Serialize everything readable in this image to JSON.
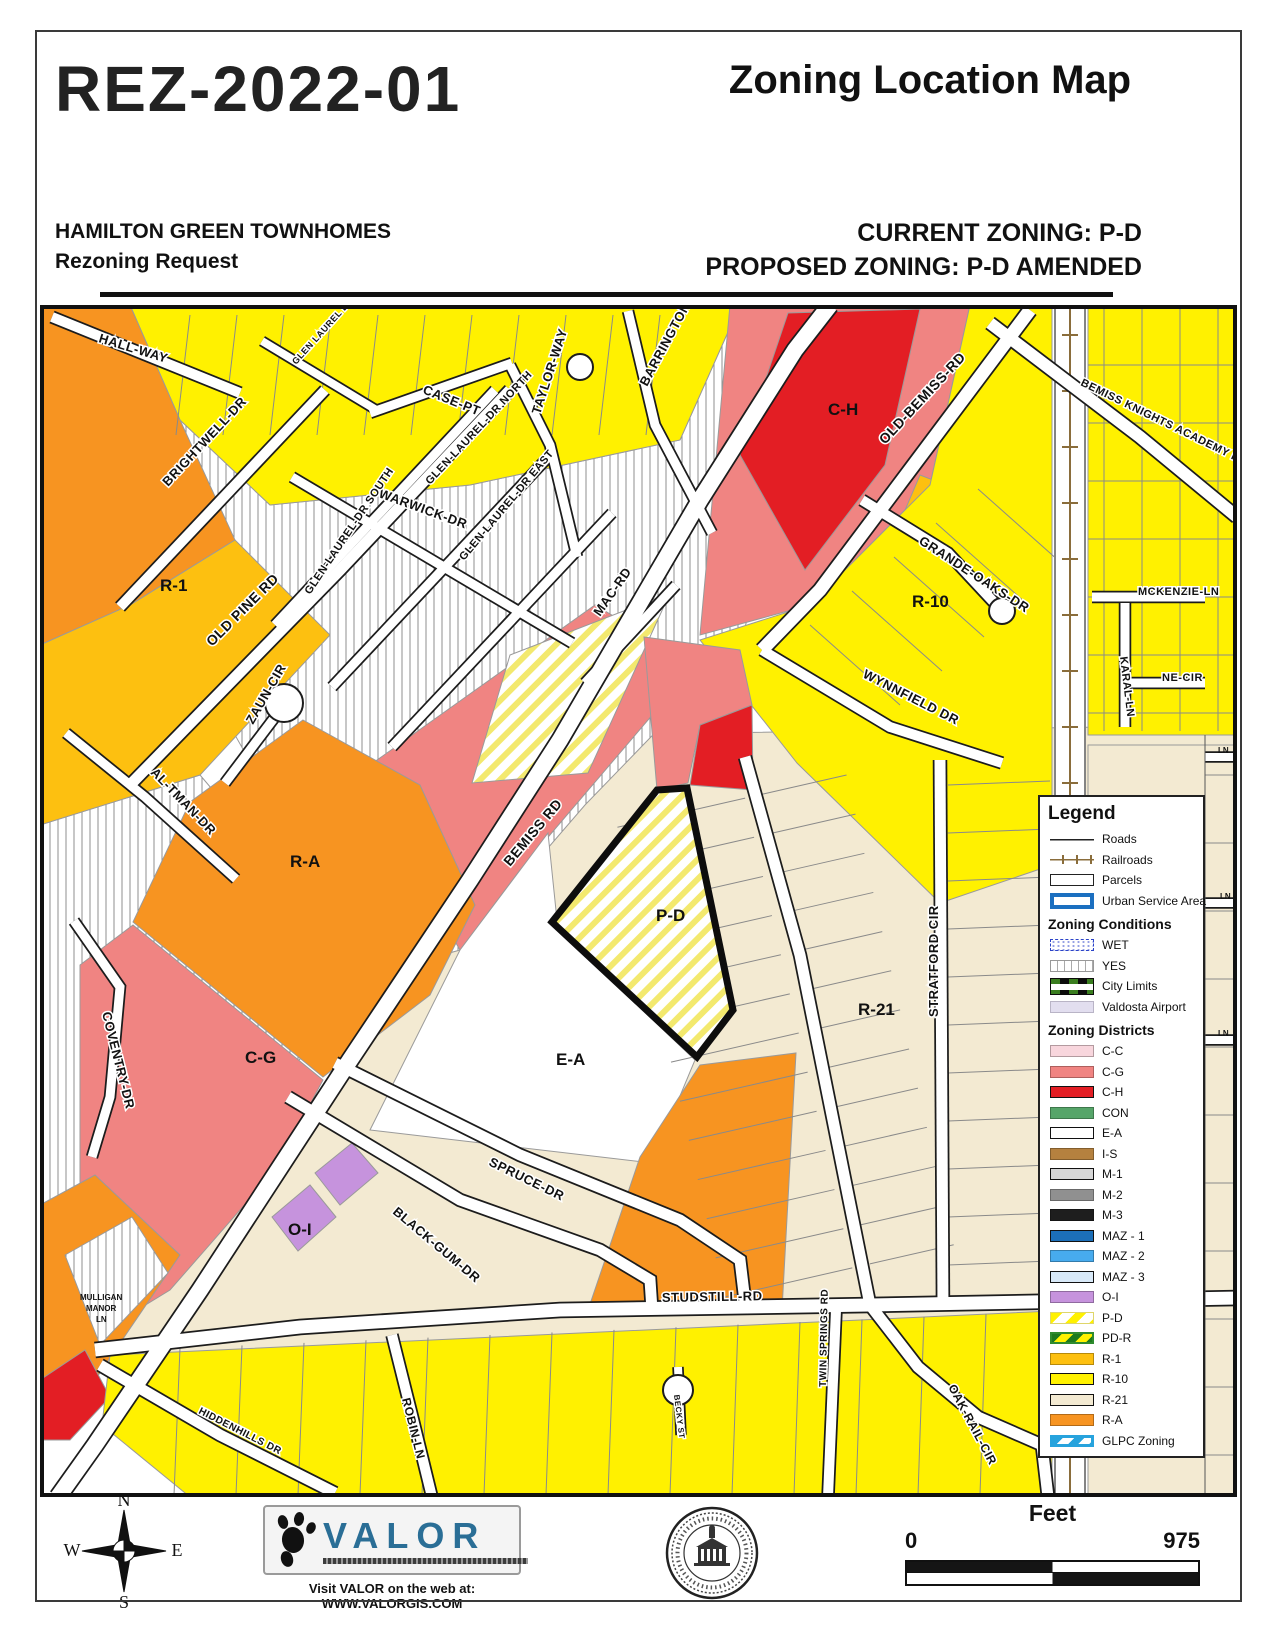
{
  "header": {
    "case_id": "REZ-2022-01",
    "map_title": "Zoning Location Map",
    "project_name": "HAMILTON GREEN TOWNHOMES",
    "request_type": "Rezoning Request",
    "current_zoning": "CURRENT ZONING: P-D",
    "proposed_zoning": "PROPOSED ZONING: P-D AMENDED"
  },
  "map": {
    "road_labels": [
      {
        "t": "HALL-WAY",
        "x": 58,
        "y": 37,
        "r": 17,
        "s": 13
      },
      {
        "t": "BRIGHTWELL-DR",
        "x": 128,
        "y": 182,
        "r": -47,
        "s": 13
      },
      {
        "t": "OLD PINE RD",
        "x": 172,
        "y": 342,
        "r": -45,
        "s": 14
      },
      {
        "t": "GLEN LAUREL DR",
        "x": 256,
        "y": 60,
        "r": -48,
        "s": 9
      },
      {
        "t": "CASE-PT",
        "x": 382,
        "y": 88,
        "r": 22,
        "s": 13
      },
      {
        "t": "TAYLOR-WAY",
        "x": 500,
        "y": 110,
        "r": -72,
        "s": 13
      },
      {
        "t": "BARRINGTON-DR",
        "x": 607,
        "y": 82,
        "r": -62,
        "s": 13
      },
      {
        "t": "GLEN-LAUREL-DR NORTH",
        "x": 390,
        "y": 180,
        "r": -47,
        "s": 11
      },
      {
        "t": "WARWICK-DR",
        "x": 338,
        "y": 192,
        "r": 20,
        "s": 13
      },
      {
        "t": "GLEN-LAUREL-DR SOUTH",
        "x": 270,
        "y": 290,
        "r": -56,
        "s": 11
      },
      {
        "t": "GLEN-LAUREL-DR EAST",
        "x": 424,
        "y": 256,
        "r": -50,
        "s": 11
      },
      {
        "t": "MAC-RD",
        "x": 560,
        "y": 312,
        "r": -55,
        "s": 13
      },
      {
        "t": "OLD-BEMISS-RD",
        "x": 845,
        "y": 140,
        "r": -47,
        "s": 14
      },
      {
        "t": "BEMISS KNIGHTS ACADEMY RD",
        "x": 1040,
        "y": 80,
        "r": 26,
        "s": 11
      },
      {
        "t": "GRANDE-OAKS-DR",
        "x": 878,
        "y": 238,
        "r": 33,
        "s": 13
      },
      {
        "t": "WYNNFIELD DR",
        "x": 822,
        "y": 372,
        "r": 27,
        "s": 13
      },
      {
        "t": "MCKENZIE-LN",
        "x": 1098,
        "y": 290,
        "r": 0,
        "s": 11
      },
      {
        "t": "KARAL-LN",
        "x": 1080,
        "y": 352,
        "r": 83,
        "s": 11
      },
      {
        "t": "NE-CIR",
        "x": 1122,
        "y": 376,
        "r": 0,
        "s": 11
      },
      {
        "t": "BEMISS RD",
        "x": 470,
        "y": 562,
        "r": -50,
        "s": 14
      },
      {
        "t": "ZAUN-CIR",
        "x": 213,
        "y": 420,
        "r": -60,
        "s": 13
      },
      {
        "t": "AL-TMAN-DR",
        "x": 110,
        "y": 468,
        "r": 46,
        "s": 13
      },
      {
        "t": "COVENTRY-DR",
        "x": 62,
        "y": 708,
        "r": 76,
        "s": 13
      },
      {
        "t": "STRATFORD CIR",
        "x": 898,
        "y": 712,
        "r": -90,
        "s": 13
      },
      {
        "t": "SPRUCE-DR",
        "x": 448,
        "y": 860,
        "r": 26,
        "s": 13
      },
      {
        "t": "BLACK-GUM-DR",
        "x": 352,
        "y": 908,
        "r": 40,
        "s": 13
      },
      {
        "t": "STUDSTILL-RD",
        "x": 622,
        "y": 997,
        "r": -1,
        "s": 13
      },
      {
        "t": "TWIN SPRINGS RD",
        "x": 786,
        "y": 1082,
        "r": -89,
        "s": 10
      },
      {
        "t": "OAK-RAIL-CIR",
        "x": 908,
        "y": 1082,
        "r": 62,
        "s": 12
      },
      {
        "t": "ROBIN-LN",
        "x": 362,
        "y": 1094,
        "r": 76,
        "s": 12
      },
      {
        "t": "BECKY ST",
        "x": 634,
        "y": 1090,
        "r": 83,
        "s": 8
      },
      {
        "t": "HIDDENHILLS DR",
        "x": 158,
        "y": 1108,
        "r": 27,
        "s": 10
      }
    ],
    "zone_labels": [
      {
        "t": "R-1",
        "x": 120,
        "y": 286
      },
      {
        "t": "C-H",
        "x": 788,
        "y": 110
      },
      {
        "t": "R-10",
        "x": 872,
        "y": 302
      },
      {
        "t": "R-A",
        "x": 250,
        "y": 562
      },
      {
        "t": "C-G",
        "x": 205,
        "y": 758
      },
      {
        "t": "P-D",
        "x": 616,
        "y": 616
      },
      {
        "t": "E-A",
        "x": 516,
        "y": 760
      },
      {
        "t": "R-21",
        "x": 818,
        "y": 710
      },
      {
        "t": "O-I",
        "x": 248,
        "y": 930
      }
    ],
    "small_labels": [
      {
        "t": "MULLIGAN",
        "x": 40,
        "y": 995,
        "s": 8
      },
      {
        "t": "MANOR",
        "x": 46,
        "y": 1006,
        "s": 8
      },
      {
        "t": "LN",
        "x": 56,
        "y": 1017,
        "s": 8
      },
      {
        "t": "LN",
        "x": 1178,
        "y": 448,
        "s": 8
      },
      {
        "t": "LN",
        "x": 1180,
        "y": 594,
        "s": 8
      },
      {
        "t": "LN",
        "x": 1178,
        "y": 731,
        "s": 8
      }
    ]
  },
  "legend": {
    "title": "Legend",
    "base_items": [
      {
        "label": "Roads",
        "swatch": "sw-road"
      },
      {
        "label": "Railroads",
        "swatch": "sw-rail"
      },
      {
        "label": "Parcels",
        "swatch": "sw-parcel"
      },
      {
        "label": "Urban Service Area",
        "swatch": "sw-usa"
      }
    ],
    "conditions_title": "Zoning Conditions",
    "conditions": [
      {
        "label": "WET",
        "swatch": "sw-wet"
      },
      {
        "label": "YES",
        "swatch": "sw-yes"
      },
      {
        "label": "City Limits",
        "swatch": "sw-city"
      },
      {
        "label": "Valdosta Airport",
        "swatch": "sw-air"
      }
    ],
    "districts_title": "Zoning Districts",
    "districts": [
      {
        "label": "C-C",
        "color": "#F8D6DD"
      },
      {
        "label": "C-G",
        "color": "#F08482"
      },
      {
        "label": "C-H",
        "color": "#E31E24",
        "outlined": true
      },
      {
        "label": "CON",
        "color": "#56A569"
      },
      {
        "label": "E-A",
        "color": "#FFFFFF",
        "outlined": true
      },
      {
        "label": "I-S",
        "color": "#B5813F"
      },
      {
        "label": "M-1",
        "color": "#D6D6D6",
        "outlined": true
      },
      {
        "label": "M-2",
        "color": "#909090"
      },
      {
        "label": "M-3",
        "color": "#1E1E1E"
      },
      {
        "label": "MAZ - 1",
        "color": "#1C6FB8",
        "outlined": true
      },
      {
        "label": "MAZ - 2",
        "color": "#47ABEE"
      },
      {
        "label": "MAZ - 3",
        "color": "#D8E9F8",
        "outlined": true
      },
      {
        "label": "O-I",
        "color": "#C693DD"
      },
      {
        "label": "P-D",
        "swatch": "sw-pd"
      },
      {
        "label": "PD-R",
        "swatch": "sw-pdr"
      },
      {
        "label": "R-1",
        "color": "#FDC010"
      },
      {
        "label": "R-10",
        "color": "#FFF100",
        "outlined": true
      },
      {
        "label": "R-21",
        "color": "#F3EAD2",
        "outlined": true
      },
      {
        "label": "R-A",
        "color": "#F79421"
      },
      {
        "label": "GLPC Zoning",
        "swatch": "sw-glpc"
      }
    ]
  },
  "footer": {
    "compass": {
      "n": "N",
      "e": "E",
      "s": "S",
      "w": "W"
    },
    "valor": {
      "name": "VALOR",
      "visit": "Visit VALOR on the web at: WWW.VALORGIS.COM"
    },
    "scale": {
      "label": "Feet",
      "start": "0",
      "end": "975"
    }
  }
}
